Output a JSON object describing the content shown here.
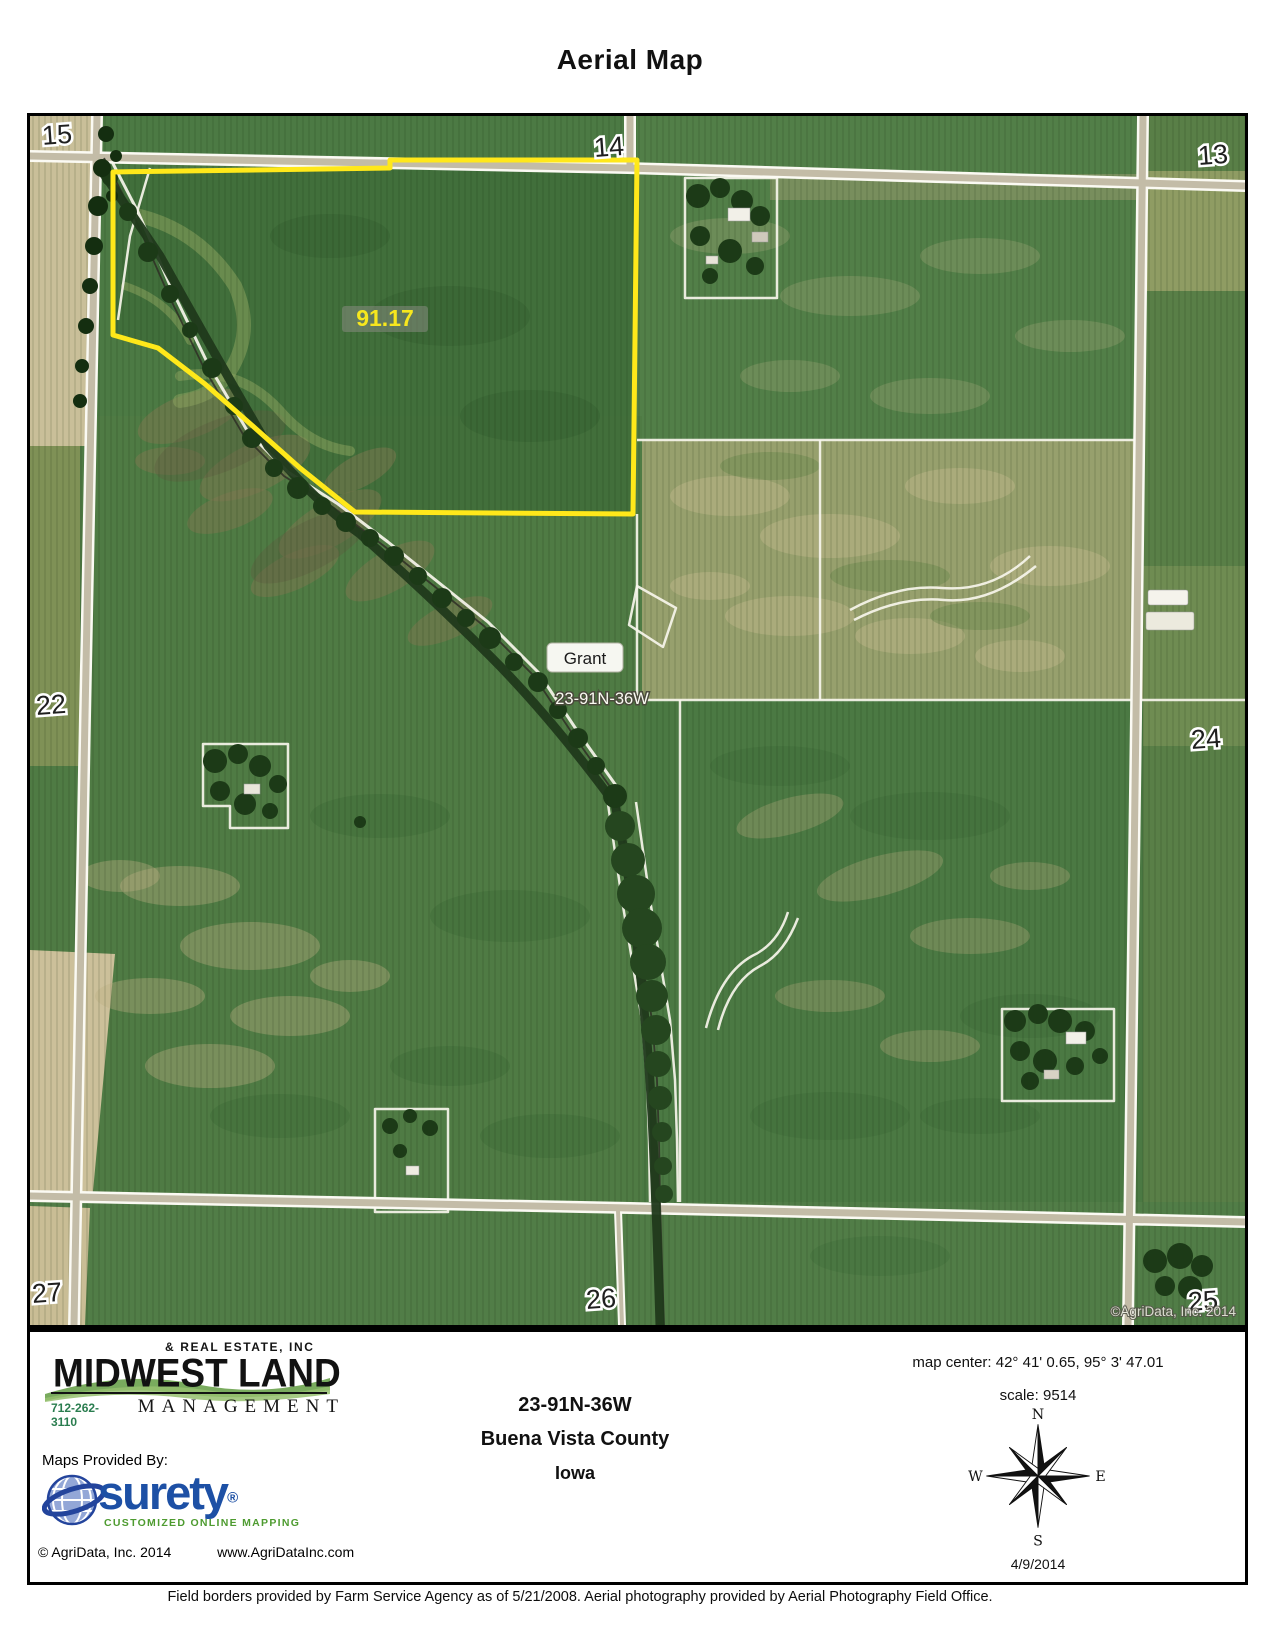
{
  "page": {
    "title": "Aerial Map",
    "footnote": "Field borders provided by Farm Service Agency as of 5/21/2008. Aerial photography provided by Aerial Photography Field Office."
  },
  "map": {
    "sections": {
      "s15": "15",
      "s14": "14",
      "s13": "13",
      "s22": "22",
      "s24": "24",
      "s27": "27",
      "s26": "26",
      "s25": "25"
    },
    "parcel_acres": "91.17",
    "place_label": "Grant",
    "township_label": "23-91N-36W",
    "watermark": "©AgriData, Inc. 2014",
    "parcel_outline_color": "#ffe81a"
  },
  "footer": {
    "company": {
      "tagline": "& REAL ESTATE, INC",
      "name": "MIDWEST LAND",
      "division": "MANAGEMENT",
      "phone": "712-262-3110"
    },
    "provider": {
      "heading": "Maps Provided By:",
      "brand": "surety",
      "registered": "®",
      "tagline": "CUSTOMIZED ONLINE MAPPING",
      "copyright": "© AgriData, Inc. 2014",
      "website": "www.AgriDataInc.com"
    },
    "location": {
      "trs": "23-91N-36W",
      "county": "Buena Vista County",
      "state": "Iowa"
    },
    "meta": {
      "map_center": "map center: 42° 41' 0.65,  95° 3' 47.01",
      "scale": "scale: 9514",
      "date": "4/9/2014"
    },
    "compass": {
      "n": "N",
      "e": "E",
      "s": "S",
      "w": "W"
    }
  }
}
